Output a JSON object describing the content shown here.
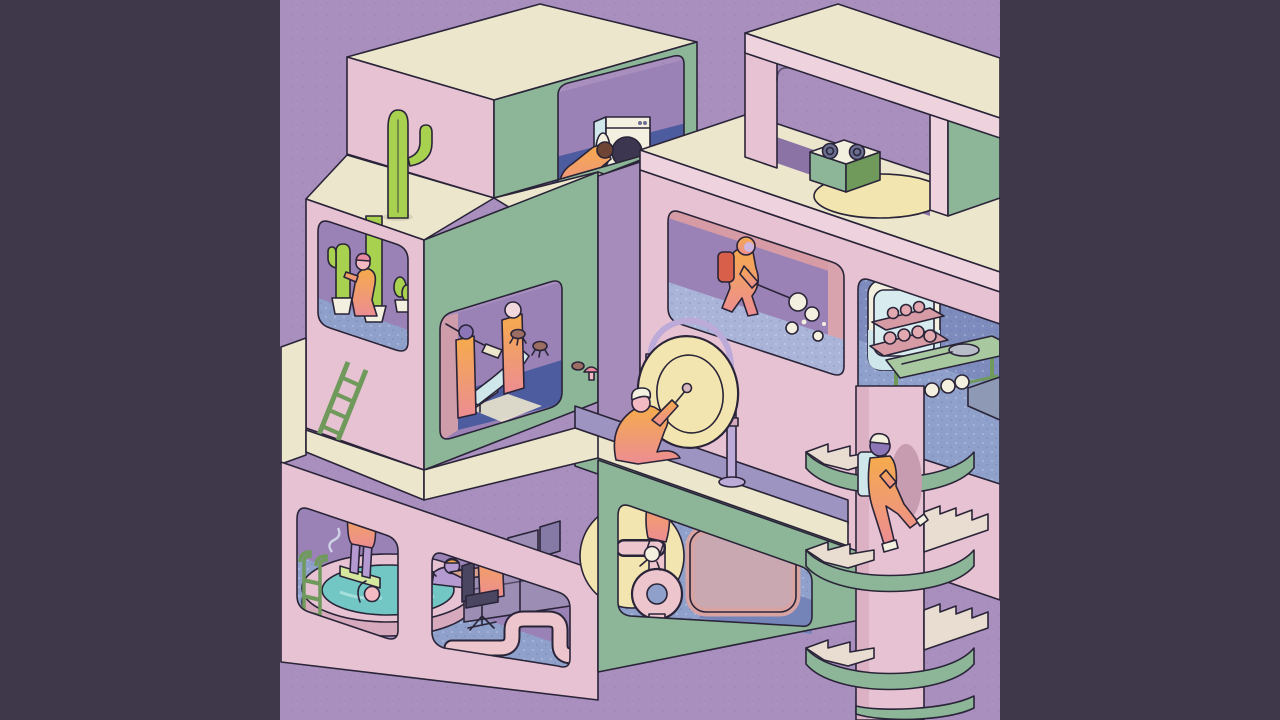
{
  "artwork": {
    "kind": "isometric-cutaway-illustration",
    "letterboxed": true,
    "visible_text": ""
  },
  "colors": {
    "ink": "#2a2438",
    "letterbox": "#3f384b",
    "background": "#a88fbe",
    "background_dot": "#9a7fb0",
    "cream": "#ece6cd",
    "pink_face": "#e7c2d3",
    "pink_pale": "#eed3de",
    "pink_deep": "#d7a9bd",
    "salmon": "#d69ba4",
    "green_face": "#8db698",
    "green_dark": "#6f9a5c",
    "purple_wall": "#9a82b6",
    "purple_side": "#a68cbb",
    "purple_shadow": "#8b73a6",
    "navy_floor": "#4d5c9e",
    "blue_floor": "#8fa0cb",
    "blue_pale": "#aab4d8",
    "blue_wall": "#7d8cbd",
    "teal_water": "#72c7c4",
    "cactus_green": "#a8d14f",
    "white": "#f4f0e0",
    "pale_blue": "#cfe6ea",
    "pale_yellow": "#f2e5b0",
    "red_tank": "#d85f4a",
    "bug_brown": "#9c6d62",
    "desk_wood": "#d8a08e",
    "gray_purple": "#9b8db4",
    "lavender": "#bcaad8",
    "lavender_skin": "#b49ad0",
    "skin_pink": "#f3bac3",
    "chair_dark": "#4a4560",
    "steam": "#d8dff0",
    "suit_top": "#f6ab4b",
    "suit_bottom": "#ec8d93",
    "bun_pink": "#e2a9b0",
    "step_tan": "#e8ddd0",
    "board_green": "#d6e8a0",
    "slab_gray": "#8e99b6"
  },
  "scene": {
    "elements": [
      {
        "name": "laundry-room",
        "prop": "washing-machine"
      },
      {
        "name": "cactus-roof",
        "prop": "tall-cactus"
      },
      {
        "name": "rooftop-kitchen",
        "prop": "two-burner-stove"
      },
      {
        "name": "cacti-nursery",
        "prop": "potted-cacti"
      },
      {
        "name": "dental-room",
        "prop": "recliner-chair"
      },
      {
        "name": "fumigation-room",
        "prop": "spray-wand"
      },
      {
        "name": "bakery-room",
        "prop": "oven-and-table"
      },
      {
        "name": "gong-ledge",
        "prop": "large-gong"
      },
      {
        "name": "hot-tub-room",
        "prop": "round-pool"
      },
      {
        "name": "office-room",
        "prop": "desk-and-monitors"
      },
      {
        "name": "pipe-room",
        "prop": "looped-pipe"
      },
      {
        "name": "spiral-staircase",
        "prop": "delivery-climber"
      },
      {
        "name": "ladder",
        "prop": "leaning-ladder"
      }
    ],
    "figures": 12
  }
}
